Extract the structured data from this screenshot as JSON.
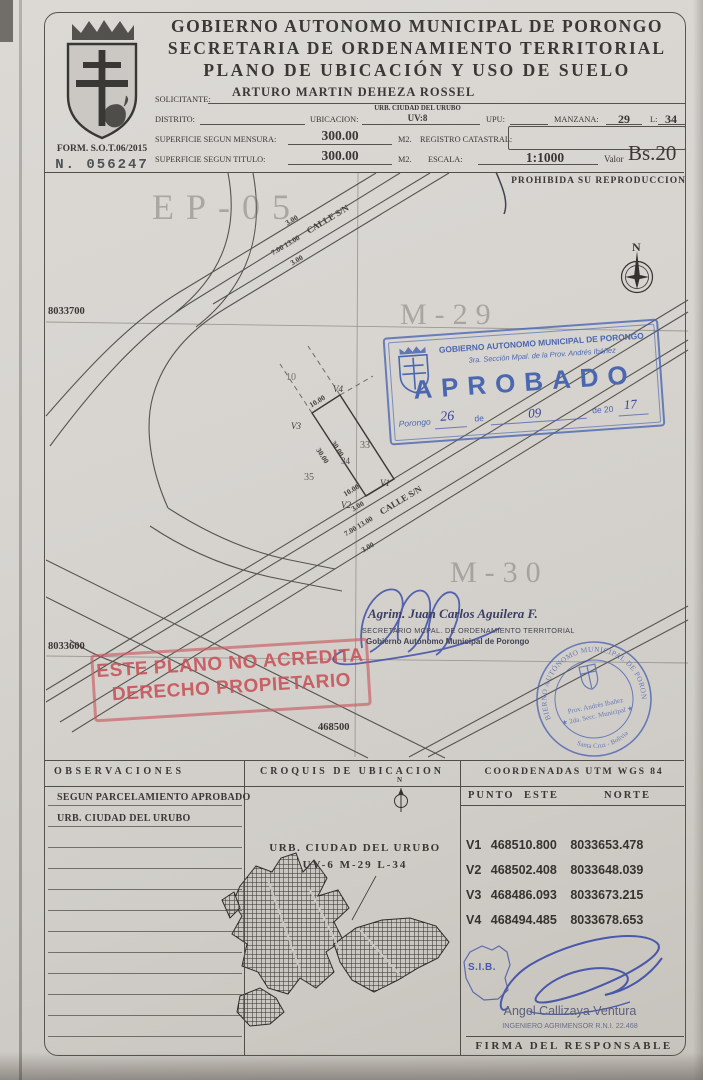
{
  "doc": {
    "title1": "GOBIERNO AUTONOMO MUNICIPAL DE PORONGO",
    "title2": "SECRETARIA DE ORDENAMIENTO TERRITORIAL",
    "title3": "PLANO DE UBICACIÓN Y USO DE SUELO",
    "form_no": "FORM. S.O.T.06/2015",
    "serial": "N.  056247"
  },
  "fields": {
    "solicitante_label": "SOLICITANTE:",
    "solicitante": "ARTURO MARTIN DEHEZA ROSSEL",
    "distrito_label": "DISTRITO:",
    "ubicacion_label": "UBICACION:",
    "ubicacion_line1": "URB. CIUDAD DEL URUBO",
    "ubicacion_line2": "UV:8",
    "upu_label": "UPU:",
    "manzana_label": "MANZANA:",
    "manzana": "29",
    "lote_label": "L:",
    "lote": "34",
    "mensura_label": "SUPERFICIE SEGUN MENSURA:",
    "mensura": "300.00",
    "m2a": "M2.",
    "registro_label": "REGISTRO CATASTRAL:",
    "titulo_label": "SUPERFICIE SEGUN TITULO:",
    "titulo": "300.00",
    "m2b": "M2.",
    "escala_label": "ESCALA:",
    "escala": "1:1000",
    "valor_label": "Valor",
    "valor": "Bs.20",
    "prohibida": "PROHIBIDA SU REPRODUCCION"
  },
  "map": {
    "zone": "EP-05",
    "m29": "M-29",
    "m30": "M-30",
    "grid_n1": "8033700",
    "grid_n2": "8033600",
    "grid_e1": "468500",
    "north": "N",
    "street_top": {
      "s1": "3.00",
      "s2": "7.00 13.00",
      "name": "CALLE S/N",
      "s3": "3.00"
    },
    "street_bottom": {
      "front": "10.00",
      "s1": "3.00",
      "s2": "7.00 13.00",
      "name": "CALLE S/N",
      "s3": "3.00"
    },
    "lot": {
      "v1": "V1",
      "v2": "V2",
      "v3": "V3",
      "v4": "V4",
      "num": "34",
      "dim_back": "10.00",
      "dim_side_l": "30.00",
      "dim_side_r": "30.00",
      "n10": "10",
      "n33": "33",
      "n35": "35"
    }
  },
  "stamp": {
    "org": "GOBIERNO AUTONOMO MUNICIPAL DE PORONGO",
    "sub": "3ra. Sección Mpal. de la Prov. Andrés Ibáñez",
    "approved": "APROBADO",
    "place": "Porongo",
    "day": "26",
    "de1": "de",
    "month": "09",
    "de2": "de 20",
    "year": "17"
  },
  "warning": {
    "line1": "ESTE PLANO NO ACREDITA",
    "line2": "DERECHO PROPIETARIO"
  },
  "secretary": {
    "name": "Agrim. Juan Carlos Aguilera F.",
    "role": "SECRETARIO MCPAL. DE ORDENAMIENTO TERRITORIAL",
    "org": "Gobierno Autónomo Municipal de Porongo"
  },
  "seal": {
    "around": "GOBIERNO AUTÓNOMO MUNICIPAL DE PORONGO",
    "prov": "Prov. Andrés Ibañez",
    "secc": "★ 2da. Secc. Municipal ★",
    "bottom": "Santa Cruz - Bolivia"
  },
  "footer": {
    "obs_header": "OBSERVACIONES",
    "obs1": "SEGUN PARCELAMIENTO APROBADO",
    "obs2": "URB. CIUDAD DEL URUBO",
    "croquis_header": "CROQUIS DE UBICACION",
    "croquis_label1": "URB. CIUDAD DEL URUBO",
    "croquis_label2": "UV-6 M-29 L-34",
    "croquis_north": "N",
    "coord_header": "COORDENADAS UTM WGS 84",
    "col_punto": "PUNTO",
    "col_este": "ESTE",
    "col_norte": "NORTE",
    "rows": [
      {
        "p": "V1",
        "e": "468510.800",
        "n": "8033653.478"
      },
      {
        "p": "V2",
        "e": "468502.408",
        "n": "8033648.039"
      },
      {
        "p": "V3",
        "e": "468486.093",
        "n": "8033673.215"
      },
      {
        "p": "V4",
        "e": "468494.485",
        "n": "8033678.653"
      }
    ],
    "sib": "S.I.B.",
    "surveyor_name": "Angel Callizaya Ventura",
    "surveyor_title": "INGENIERO AGRIMENSOR R.N.I. 22.468",
    "firma": "FIRMA DEL RESPONSABLE"
  },
  "colors": {
    "stamp_blue": "#4a67b0",
    "stamp_red": "#c75f66",
    "ink": "#3c3a36",
    "paper": "#d8d5d0"
  }
}
